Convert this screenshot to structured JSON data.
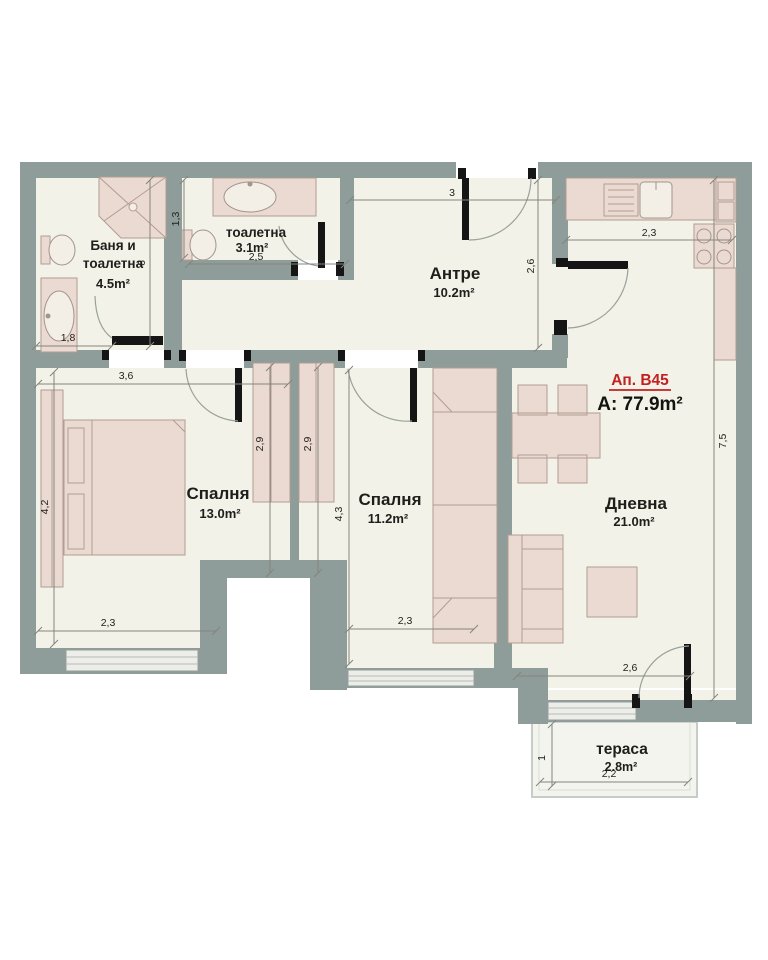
{
  "apartment": {
    "id": "Ап. B45",
    "area": "A: 77.9m²"
  },
  "rooms": {
    "bathroom": {
      "name_line1": "Баня и",
      "name_line2": "тоалетна",
      "area": "4.5m²"
    },
    "toilet": {
      "name": "тоалетна",
      "area": "3.1m²"
    },
    "hall": {
      "name": "Антре",
      "area": "10.2m²"
    },
    "bedroom1": {
      "name": "Спалня",
      "area": "13.0m²"
    },
    "bedroom2": {
      "name": "Спалня",
      "area": "11.2m²"
    },
    "living": {
      "name": "Дневна",
      "area": "21.0m²"
    },
    "terrace": {
      "name": "тераса",
      "area": "2.8m²"
    }
  },
  "dimensions": {
    "hall_width": "3",
    "hall_depth": "2,6",
    "kitchen_width": "2,3",
    "toilet_niche_depth": "1,3",
    "toilet_width": "2,5",
    "bathroom_entry_width": "1,8",
    "bathroom_depth": "6",
    "bedroom1_width": "3,6",
    "bedroom1_depth": "4,2",
    "bedroom1_window": "2,3",
    "wardrobe_left": "2,9",
    "wardrobe_right": "2,9",
    "bedroom2_depth": "4,3",
    "bedroom2_window": "2,3",
    "living_depth": "7,5",
    "living_window": "2,6",
    "terrace_depth": "1",
    "terrace_width": "2,2"
  },
  "colors": {
    "wall": "#8e9d9a",
    "floor": "#f2f2e9",
    "furniture": "#eadad2",
    "furniture_outline": "#b39c92",
    "accent": "#c32020",
    "window_band": "#ededea",
    "dimension_line": "#85857d",
    "door": "#151515"
  }
}
